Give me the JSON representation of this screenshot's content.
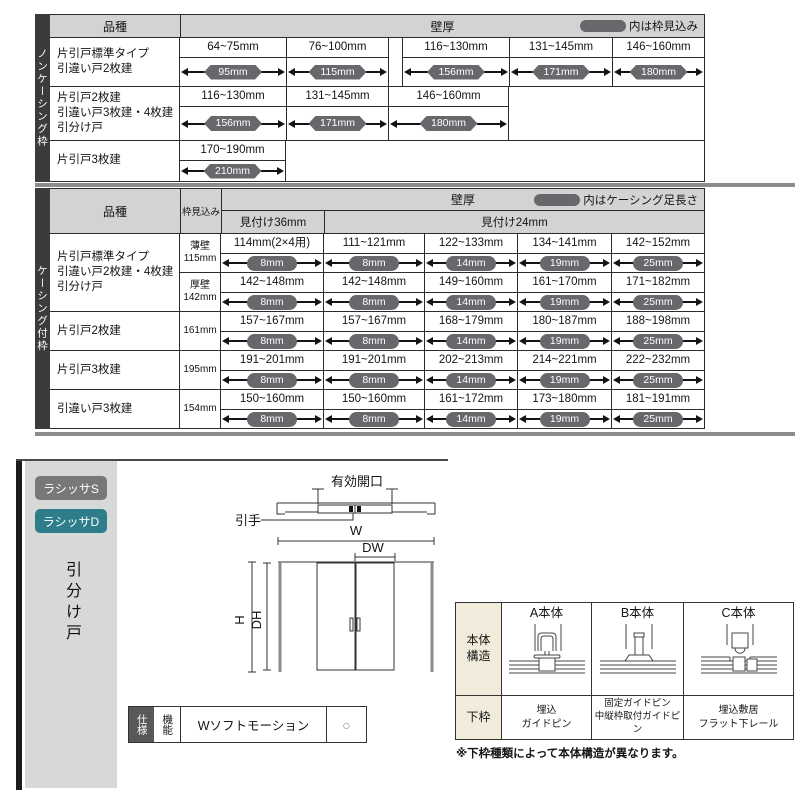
{
  "colors": {
    "capsule": "#67686b",
    "header_bg": "#d2d3d3",
    "side_strip": "#3b3b3d",
    "badge_s": "#77787a",
    "badge_d": "#2e7d8a",
    "label_beige": "#f0ebda"
  },
  "table1": {
    "side_label": "ノンケーシング枠",
    "header": {
      "product": "品種",
      "wall": "壁厚",
      "legend_note": "内は枠見込み"
    },
    "rows": [
      {
        "label": "片引戸標準タイプ\n引違い戸2枚建",
        "cells": [
          [
            "64~75mm",
            "95mm"
          ],
          [
            "76~100mm",
            "115mm"
          ],
          [
            "116~130mm",
            "156mm"
          ],
          [
            "131~145mm",
            "171mm"
          ],
          [
            "146~160mm",
            "180mm"
          ]
        ]
      },
      {
        "label": "片引戸2枚建\n引違い戸3枚建・4枚建\n引分け戸",
        "cells": [
          [
            "116~130mm",
            "156mm"
          ],
          [
            "131~145mm",
            "171mm"
          ],
          [
            "146~160mm",
            "180mm"
          ]
        ]
      },
      {
        "label": "片引戸3枚建",
        "cells": [
          [
            "170~190mm",
            "210mm"
          ]
        ]
      }
    ]
  },
  "table2": {
    "side_label": "ケーシング付枠",
    "header": {
      "product": "品種",
      "waku": "枠見込み",
      "wall": "壁厚",
      "legend_note": "内はケーシング足長さ",
      "col36": "見付け36mm",
      "col24": "見付け24mm"
    },
    "groups": [
      {
        "label": "片引戸標準タイプ\n引違い戸2枚建・4枚建\n引分け戸",
        "rows": [
          {
            "waku": "薄壁\n115mm",
            "cells": [
              [
                "114mm(2×4用)",
                "8mm"
              ],
              [
                "111~121mm",
                "8mm"
              ],
              [
                "122~133mm",
                "14mm"
              ],
              [
                "134~141mm",
                "19mm"
              ],
              [
                "142~152mm",
                "25mm"
              ]
            ]
          },
          {
            "waku": "厚壁\n142mm",
            "cells": [
              [
                "142~148mm",
                "8mm"
              ],
              [
                "142~148mm",
                "8mm"
              ],
              [
                "149~160mm",
                "14mm"
              ],
              [
                "161~170mm",
                "19mm"
              ],
              [
                "171~182mm",
                "25mm"
              ]
            ]
          }
        ]
      },
      {
        "label": "片引戸2枚建",
        "rows": [
          {
            "waku": "161mm",
            "cells": [
              [
                "157~167mm",
                "8mm"
              ],
              [
                "157~167mm",
                "8mm"
              ],
              [
                "168~179mm",
                "14mm"
              ],
              [
                "180~187mm",
                "19mm"
              ],
              [
                "188~198mm",
                "25mm"
              ]
            ]
          }
        ]
      },
      {
        "label": "片引戸3枚建",
        "rows": [
          {
            "waku": "195mm",
            "cells": [
              [
                "191~201mm",
                "8mm"
              ],
              [
                "191~201mm",
                "8mm"
              ],
              [
                "202~213mm",
                "14mm"
              ],
              [
                "214~221mm",
                "19mm"
              ],
              [
                "222~232mm",
                "25mm"
              ]
            ]
          }
        ]
      },
      {
        "label": "引違い戸3枚建",
        "rows": [
          {
            "waku": "154mm",
            "cells": [
              [
                "150~160mm",
                "8mm"
              ],
              [
                "150~160mm",
                "8mm"
              ],
              [
                "161~172mm",
                "14mm"
              ],
              [
                "173~180mm",
                "19mm"
              ],
              [
                "181~191mm",
                "25mm"
              ]
            ]
          }
        ]
      }
    ]
  },
  "bottom": {
    "badge_s": "ラシッサS",
    "badge_d": "ラシッサD",
    "side_label": "引分け戸",
    "diagram": {
      "opening": "有効開口",
      "handle": "引手",
      "w": "W",
      "dw": "DW",
      "h": "H",
      "dh": "DH"
    },
    "structure": {
      "body_header": "本体\n構造",
      "lower_header": "下枠",
      "columns": [
        {
          "title": "A本体",
          "lower": "埋込\nガイドピン"
        },
        {
          "title": "B本体",
          "lower": "固定ガイドピン\n中縦枠取付ガイドピン"
        },
        {
          "title": "C本体",
          "lower": "埋込敷居\nフラット下レール"
        }
      ],
      "note": "※下枠種類によって本体構造が異なります。"
    },
    "spec": {
      "col1": "仕様",
      "col2": "機能",
      "feature": "Wソフトモーション",
      "mark": "○"
    }
  }
}
